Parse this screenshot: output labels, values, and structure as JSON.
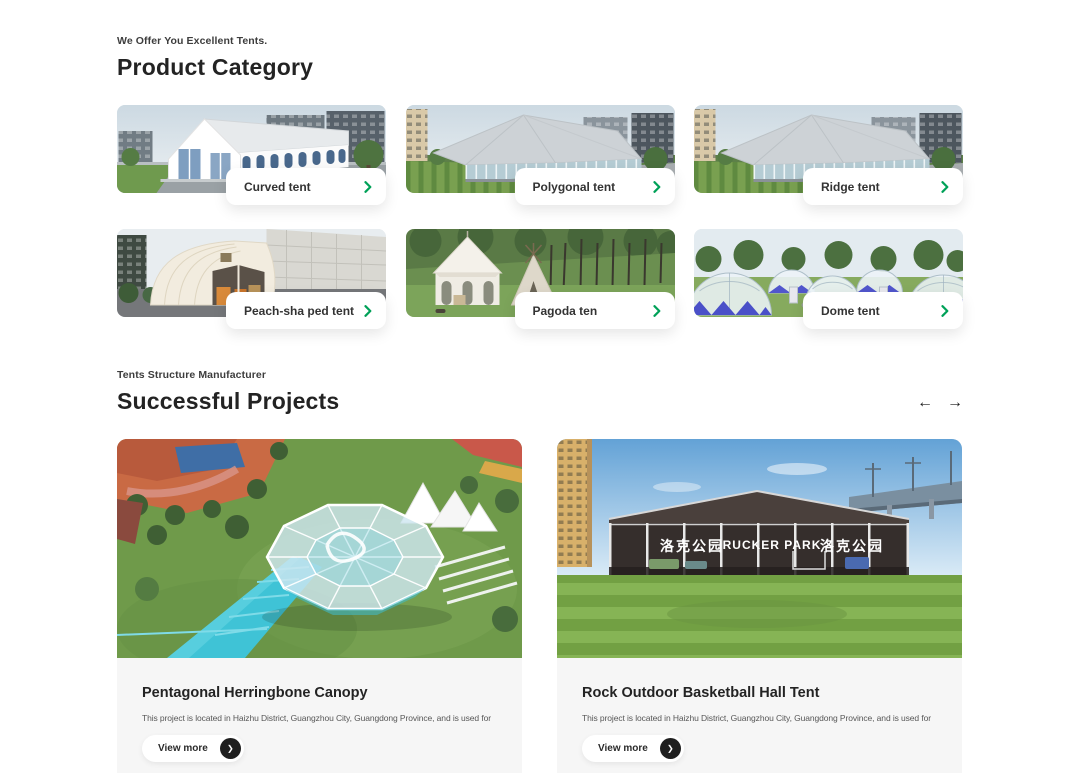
{
  "colors": {
    "accent_green": "#00a158",
    "dark_button": "#1f1f1f",
    "project_info_bg": "#f6f6f6"
  },
  "product_category": {
    "eyebrow": "We Offer You Excellent Tents.",
    "title": "Product Category",
    "cards": [
      {
        "label": "Curved tent"
      },
      {
        "label": "Polygonal tent"
      },
      {
        "label": "Ridge tent"
      },
      {
        "label": "Peach-sha ped tent"
      },
      {
        "label": "Pagoda ten"
      },
      {
        "label": "Dome tent"
      }
    ]
  },
  "successful_projects": {
    "eyebrow": "Tents Structure Manufacturer",
    "title": "Successful Projects",
    "nav": {
      "prev": "←",
      "next": "→"
    },
    "projects": [
      {
        "title": "Pentagonal Herringbone Canopy",
        "description": "This project is located in Haizhu District, Guangzhou City, Guangdong Province, and is used for",
        "button": "View more"
      },
      {
        "title": "Rock Outdoor Basketball Hall Tent",
        "description": "This project is located in Haizhu District, Guangzhou City, Guangdong Province, and is used for",
        "button": "View more",
        "signage": {
          "left": "洛克公园",
          "center": "RUCKER PARK",
          "right": "洛克公园"
        }
      }
    ]
  }
}
